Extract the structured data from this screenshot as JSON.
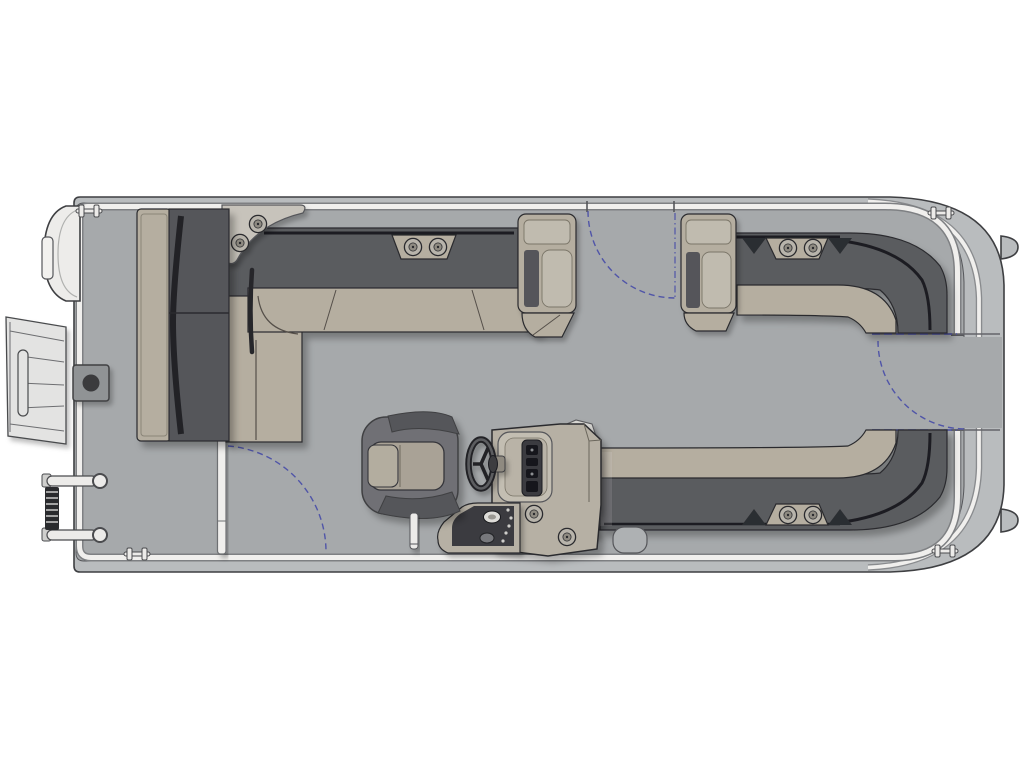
{
  "page": {
    "background": "#ffffff",
    "description": "Top-down floor plan of a pontoon boat with bow at right, stern swim deck at left, twin bow L-lounges, stern wrap-around lounge, forward-facing stern couch, helm console with steering wheel and captain's chair"
  },
  "palette": {
    "page-bg": "#ffffff",
    "hull": "#b9bcbe",
    "deck": "#a6a9ab",
    "fence": "#f0efed",
    "fence-edge": "#7e8083",
    "line": "#2a2b2e",
    "outline": "#3e3f42",
    "seat-tan": "#b5aea0",
    "seat-tan-light": "#c0bbaf",
    "cushion-dark": "#55565a",
    "backrest-dark": "#5a5b5f",
    "accent-black": "#1d1e21",
    "caddy": "#c7c3bb",
    "chair-shell": "#6f7074",
    "chair-wing": "#55565a",
    "chair-pad": "#a9a296",
    "console": "#b6b0a4",
    "console-panel": "#3a3b3f",
    "cup-outer": "#b8b4ab",
    "cup-inner": "#8f8b82",
    "white-part": "#ecebe9",
    "gate-blue": "#5055a8",
    "steps": "#e3e3e2"
  },
  "parts": {
    "stern_swim_steps": 1,
    "folded_boarding_ladder": 1,
    "pontoon_nose_cone": 1,
    "stern_nav_light": 1,
    "cleats": 4,
    "gates": 3,
    "gate_swing_arcs": 3,
    "cup_holders_total": 10,
    "lounges": {
      "stern_couch": 1,
      "stern_l_lounge": 1,
      "bow_l_lounge_port": 1,
      "bow_l_lounge_starboard": 1
    },
    "armrest_consoles": 3,
    "helm": {
      "steering_wheel": 1,
      "gauge_cluster": 1,
      "switch_panel": 1,
      "console_cup_holders": 2
    },
    "captains_chair": 1,
    "ski_tow_post": 1,
    "table_pedestal_base": 1,
    "motor_mount_tabs": 2
  }
}
